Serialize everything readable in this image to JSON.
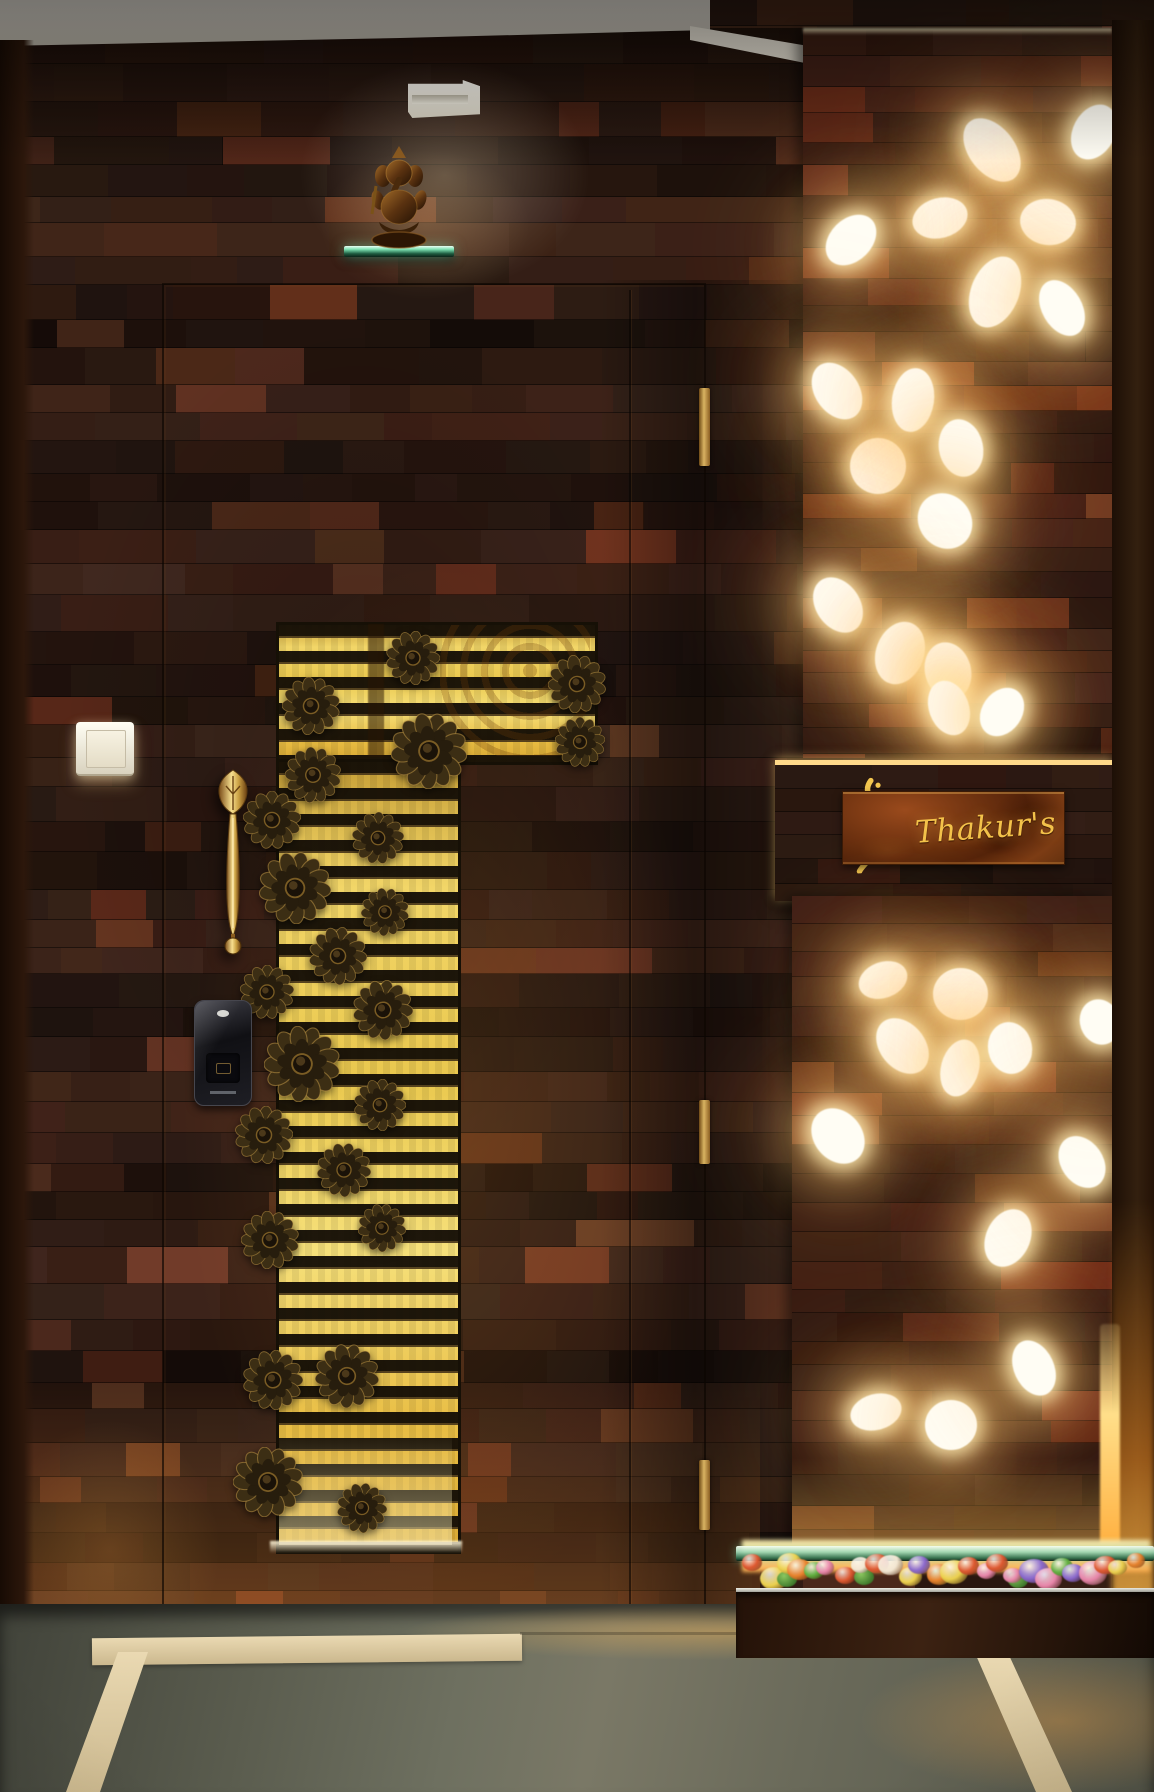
{
  "scene": {
    "label": "Residential entrance foyer with wooden wall, carved golden door grille, backlit jali panels and name board"
  },
  "nameplate": {
    "text": "Thakur's"
  },
  "icons": {
    "deity": "ganesha-statue",
    "lock": "digital-keypad-lock",
    "handle": "brass-leaf-handle",
    "bell": "doorbell-switch",
    "ornament": "sunflower-medallion",
    "monogram": "calligraphic-monogram"
  },
  "colors": {
    "ceiling": "#e4e0d6",
    "wall_dark": "#2e1b10",
    "wall_accent": "#7a4322",
    "gold_light": "#f6e07a",
    "gold_mid": "#e0b23e",
    "slat_dark": "#1c140a",
    "glow_core": "#fffdf2",
    "glow_halo": "#ffd998",
    "brass": "#cfa852",
    "bronze_flower": "#3c2e14",
    "lock_body": "#17171c",
    "glass_green": "#7fe3b4",
    "floor_grey": "#6b6d5c",
    "floor_strip": "#e7d8ae",
    "plaque_rust": "#6e3210",
    "script_gold": "#f3c24a",
    "amber_glow": "#ffb040"
  },
  "geometry": {
    "panels": {
      "top": [
        803,
        30,
        309,
        728
      ],
      "bottom": [
        792,
        896,
        320,
        652
      ]
    },
    "ovals": {
      "top": [
        [
          992,
          150,
          46,
          72,
          -38
        ],
        [
          940,
          218,
          40,
          56,
          75
        ],
        [
          1048,
          222,
          56,
          46,
          8
        ],
        [
          995,
          292,
          48,
          74,
          22
        ],
        [
          1062,
          308,
          40,
          60,
          -30
        ],
        [
          851,
          240,
          42,
          58,
          45
        ],
        [
          1094,
          132,
          42,
          58,
          28
        ],
        [
          878,
          466,
          56,
          56,
          0
        ],
        [
          837,
          391,
          44,
          62,
          -35
        ],
        [
          913,
          400,
          42,
          64,
          8
        ],
        [
          961,
          448,
          58,
          44,
          78
        ],
        [
          945,
          521,
          52,
          58,
          -40
        ],
        [
          838,
          605,
          44,
          60,
          -35
        ],
        [
          900,
          653,
          48,
          64,
          20
        ],
        [
          948,
          671,
          58,
          46,
          75
        ],
        [
          949,
          708,
          40,
          56,
          -20
        ],
        [
          1002,
          712,
          40,
          52,
          35
        ]
      ],
      "bottom": [
        [
          883,
          980,
          50,
          36,
          -20
        ],
        [
          960,
          994,
          55,
          52,
          0
        ],
        [
          902,
          1046,
          45,
          62,
          -40
        ],
        [
          960,
          1068,
          38,
          58,
          15
        ],
        [
          1010,
          1048,
          52,
          44,
          80
        ],
        [
          838,
          1136,
          48,
          60,
          -40
        ],
        [
          1008,
          1238,
          44,
          60,
          25
        ],
        [
          1082,
          1162,
          42,
          56,
          -35
        ],
        [
          1100,
          1022,
          46,
          40,
          70
        ],
        [
          876,
          1412,
          52,
          36,
          -15
        ],
        [
          951,
          1425,
          52,
          50,
          0
        ],
        [
          1034,
          1368,
          40,
          58,
          -25
        ]
      ]
    },
    "grille": {
      "wide": [
        276,
        622,
        316,
        137
      ],
      "narrow": [
        276,
        759,
        179,
        789
      ],
      "slat_period": 26,
      "flowers": [
        [
          413,
          658,
          54
        ],
        [
          311,
          706,
          58
        ],
        [
          429,
          751,
          76
        ],
        [
          577,
          684,
          58
        ],
        [
          580,
          742,
          50
        ],
        [
          313,
          775,
          56
        ],
        [
          272,
          820,
          58
        ],
        [
          378,
          838,
          52
        ],
        [
          295,
          888,
          72
        ],
        [
          385,
          912,
          48
        ],
        [
          338,
          956,
          58
        ],
        [
          267,
          992,
          54
        ],
        [
          383,
          1010,
          60
        ],
        [
          302,
          1064,
          76
        ],
        [
          380,
          1105,
          52
        ],
        [
          264,
          1135,
          58
        ],
        [
          344,
          1170,
          54
        ],
        [
          270,
          1240,
          58
        ],
        [
          382,
          1228,
          48
        ],
        [
          273,
          1380,
          60
        ],
        [
          347,
          1376,
          64
        ],
        [
          268,
          1482,
          70
        ],
        [
          362,
          1508,
          50
        ]
      ]
    },
    "planter": {
      "flower_colors": [
        "#e8822c",
        "#e886aa",
        "#ecd14e",
        "#8a68cc",
        "#5fae3e",
        "#dd5830",
        "#f2e6d2"
      ],
      "flower_count": 26
    }
  }
}
